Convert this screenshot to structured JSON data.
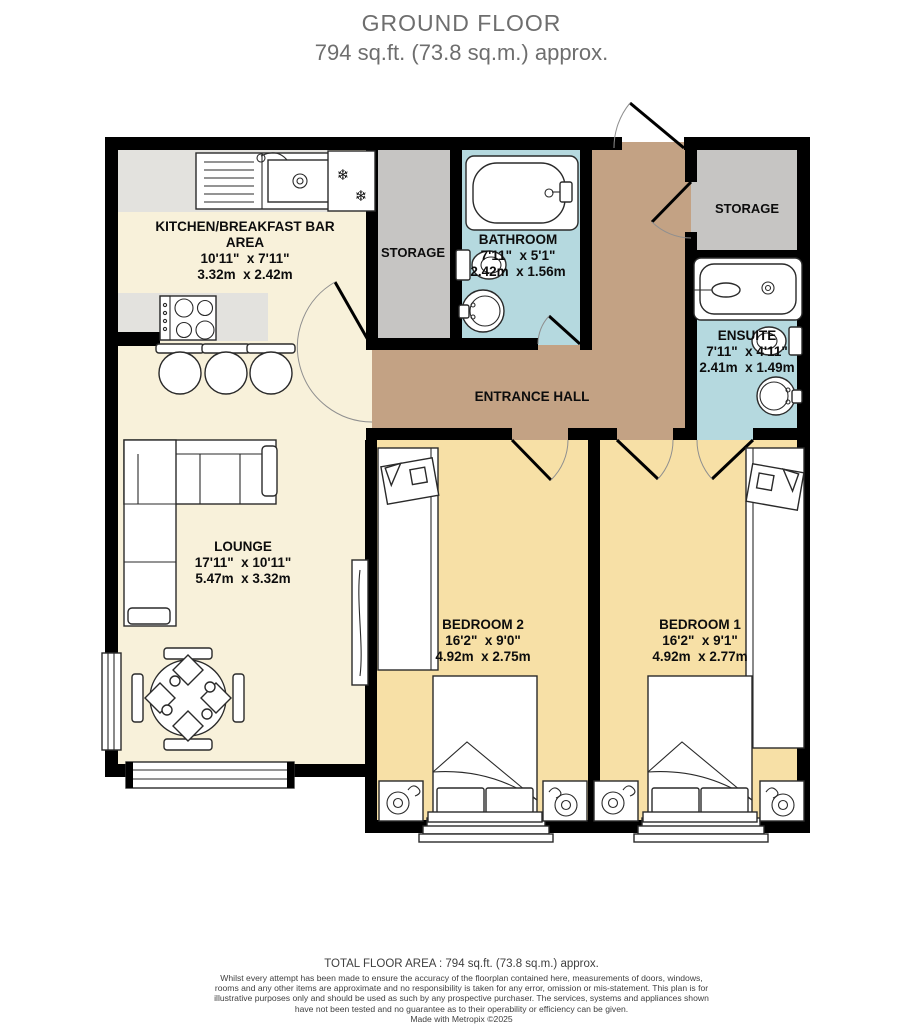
{
  "title": {
    "line1": "GROUND FLOOR",
    "line2": "794 sq.ft. (73.8 sq.m.) approx."
  },
  "rooms": {
    "kitchen": {
      "name": "KITCHEN/BREAKFAST BAR",
      "name2": "AREA",
      "imperial": "10'11\"  x 7'11\"",
      "metric": "3.32m  x 2.42m"
    },
    "storage_left": {
      "name": "STORAGE"
    },
    "bathroom": {
      "name": "BATHROOM",
      "imperial": "7'11\"  x 5'1\"",
      "metric": "2.42m  x 1.56m"
    },
    "storage_right": {
      "name": "STORAGE"
    },
    "ensuite": {
      "name": "ENSUITE",
      "imperial": "7'11\"  x 4'11\"",
      "metric": "2.41m  x 1.49m"
    },
    "entrance_hall": {
      "name": "ENTRANCE HALL"
    },
    "lounge": {
      "name": "LOUNGE",
      "imperial": "17'11\"  x 10'11\"",
      "metric": "5.47m  x 3.32m"
    },
    "bedroom2": {
      "name": "BEDROOM 2",
      "imperial": "16'2\"  x 9'0\"",
      "metric": "4.92m  x 2.75m"
    },
    "bedroom1": {
      "name": "BEDROOM 1",
      "imperial": "16'2\"  x 9'1\"",
      "metric": "4.92m  x 2.77m"
    }
  },
  "footer": {
    "total": "TOTAL FLOOR AREA : 794 sq.ft. (73.8 sq.m.) approx.",
    "disclaimer": "Whilst every attempt has been made to ensure the accuracy of the floorplan contained here, measurements of doors, windows, rooms and any other items are approximate and no responsibility is taken for any error, omission or mis-statement. This plan is for illustrative purposes only and should be used as such by any prospective purchaser. The services, systems and appliances shown have not been tested and no guarantee as to their operability or efficiency can be given.",
    "credit": "Made with Metropix ©2025"
  },
  "colors": {
    "wall": "#000000",
    "open_plan": "#f8f1da",
    "bedroom": "#f7e0a6",
    "wet_room": "#b5d9df",
    "hall": "#c3a284",
    "storage": "#c6c5c3",
    "counter": "#e3e2de",
    "title_text": "#6e6e6e",
    "footer_text": "#3f3f3f"
  }
}
